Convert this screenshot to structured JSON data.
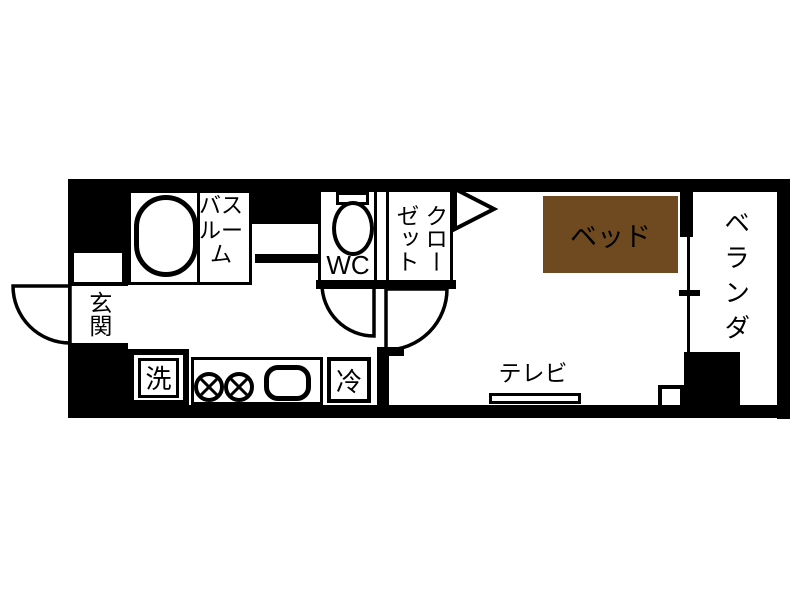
{
  "floor_plan": {
    "background": "#ffffff",
    "wall_color": "#000000",
    "rooms": {
      "entrance": {
        "label": "玄関"
      },
      "bathroom": {
        "label_lines": [
          "バス",
          "ルーム"
        ]
      },
      "wc": {
        "label": "WC"
      },
      "closet": {
        "label_columns": [
          "クロー",
          "ゼット"
        ]
      },
      "bedroom": {
        "bed_label": "ベッド",
        "bed_color": "#6f4a21",
        "tv_label": "テレビ"
      },
      "veranda": {
        "label": "ベランダ"
      },
      "kitchen": {
        "washer_label": "洗",
        "fridge_label": "冷"
      }
    }
  }
}
